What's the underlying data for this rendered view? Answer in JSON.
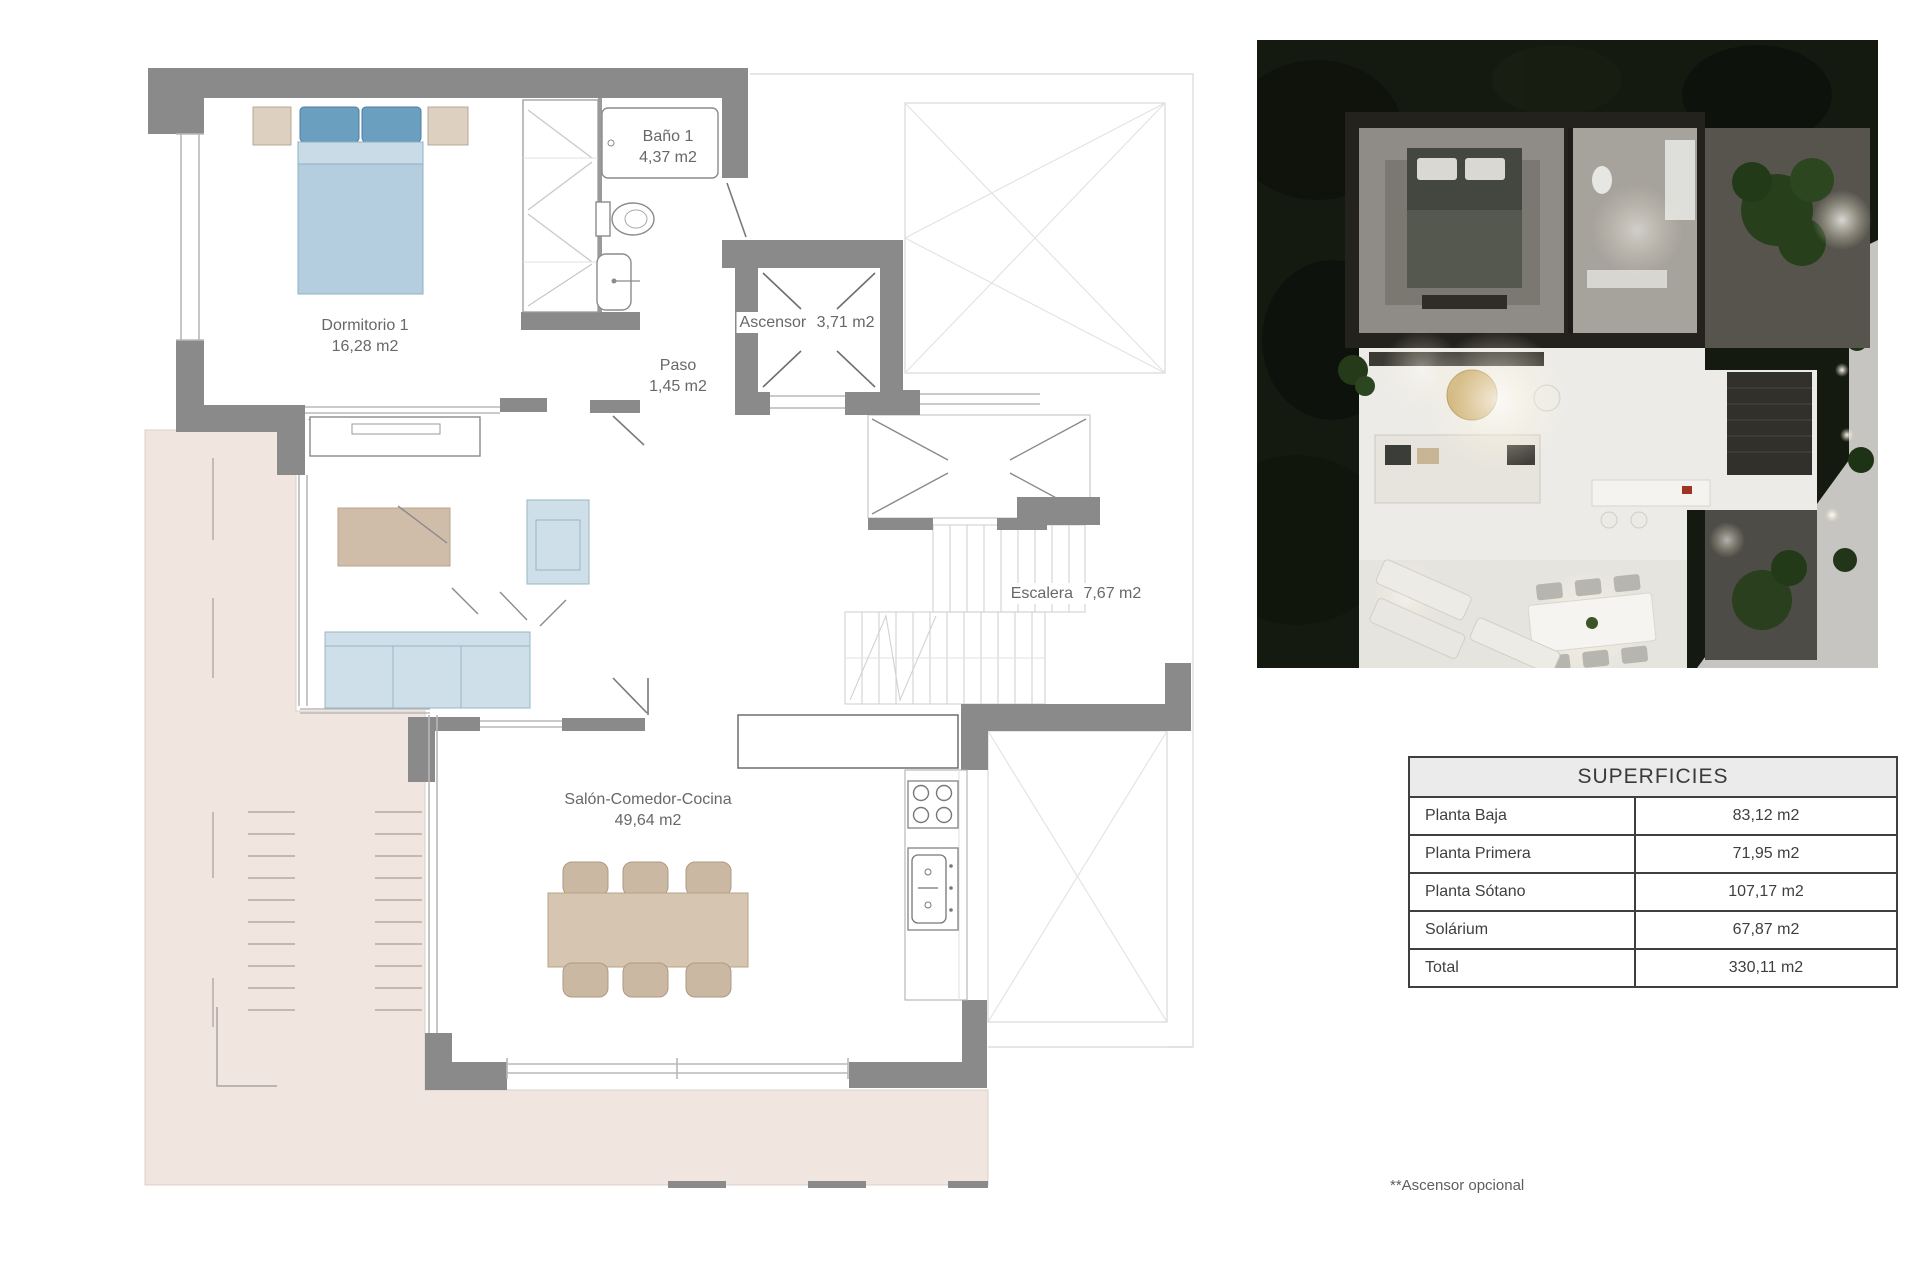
{
  "plan": {
    "rooms": {
      "dormitorio": {
        "name": "Dormitorio 1",
        "area": "16,28 m2"
      },
      "bano": {
        "name": "Baño 1",
        "area": "4,37 m2"
      },
      "paso": {
        "name": "Paso",
        "area": "1,45 m2"
      },
      "ascensor": {
        "name": "Ascensor",
        "area": "3,71 m2"
      },
      "escalera": {
        "name": "Escalera",
        "area": "7,67 m2"
      },
      "salon": {
        "name": "Salón-Comedor-Cocina",
        "area": "49,64 m2"
      }
    }
  },
  "superficies": {
    "title": "SUPERFICIES",
    "rows": [
      {
        "label": "Planta Baja",
        "value": "83,12 m2"
      },
      {
        "label": "Planta Primera",
        "value": "71,95 m2"
      },
      {
        "label": "Planta Sótano",
        "value": "107,17 m2"
      },
      {
        "label": "Solárium",
        "value": "67,87 m2"
      },
      {
        "label": "Total",
        "value": "330,11 m2"
      }
    ]
  },
  "footnote": "**Ascensor opcional",
  "colors": {
    "wall": "#8a8a8a",
    "terrace_pink": "#f0e5df",
    "bed_blue": "#b5cedf",
    "bed_band": "#c9dbe7",
    "pillow_blue": "#6b9fc0",
    "sofa_blue": "#cfdfe9",
    "wood_beige": "#d6c5b1",
    "chair_beige": "#cbb8a2",
    "rug_tan": "#cfbca9",
    "nightstand": "#ddd0c0",
    "line_gray": "#b8b8b8",
    "text_gray": "#686868",
    "table_border": "#3f3f3f",
    "render_bg": "#151a11"
  }
}
